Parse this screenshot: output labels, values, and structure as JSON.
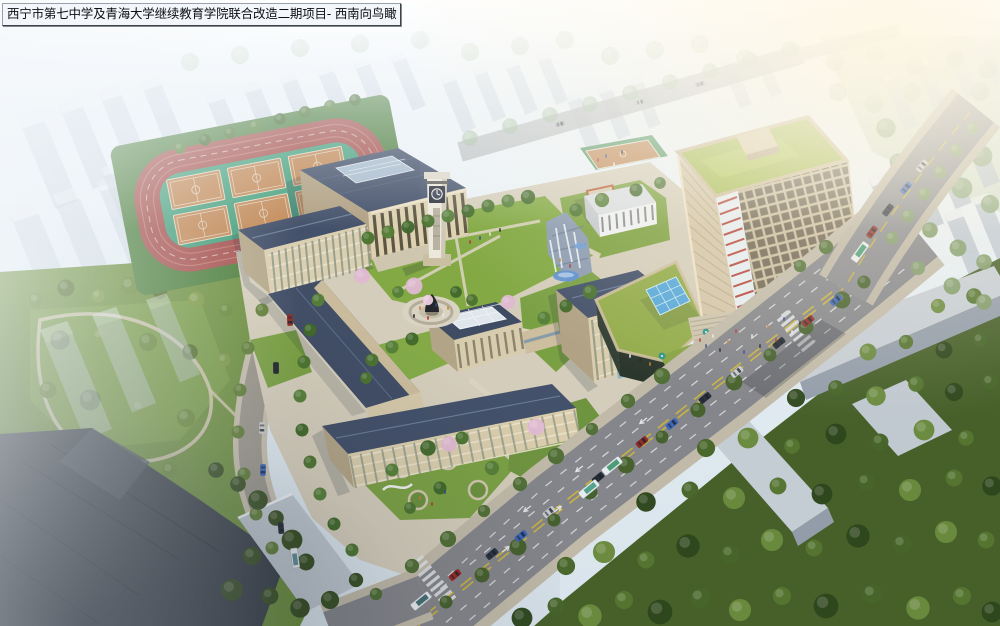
{
  "title": {
    "text": "西宁市第七中学及青海大学继续教育学院联合改造二期项目- 西南向鸟瞰"
  },
  "scene": {
    "type": "architectural-aerial-rendering",
    "view": "southwest-birds-eye",
    "landmarks": [
      "running-track-with-six-basketball-courts",
      "auditorium-with-colonnade",
      "classroom-buildings-with-slate-roofs",
      "white-clock-tower",
      "statue-plaza",
      "campus-lawns-with-cherry-trees",
      "waterfall-water-feature",
      "highrise-tower-with-green-roof",
      "podium-with-glass-pyramid-skylight",
      "grand-entry-stairs-with-umbrellas",
      "main-road-with-traffic",
      "hazy-city-blocks",
      "park-with-looping-paths",
      "dense-tree-grove"
    ]
  },
  "palette": {
    "haze_sky": "#e9eff5",
    "roof_slate": "#46536c",
    "wall_beige": "#d9cdae",
    "lawn_green": "#82a944",
    "track_red": "#a5524e",
    "field_green": "#47a07d",
    "court_tan": "#c28a58",
    "road_gray": "#85868b",
    "marking_yellow": "#cdb53a",
    "tower_green_roof": "#a6bb52",
    "accent_red": "#b03528",
    "water_blue": "#5b8fd0",
    "blossom_pink": "#e0bad2"
  }
}
